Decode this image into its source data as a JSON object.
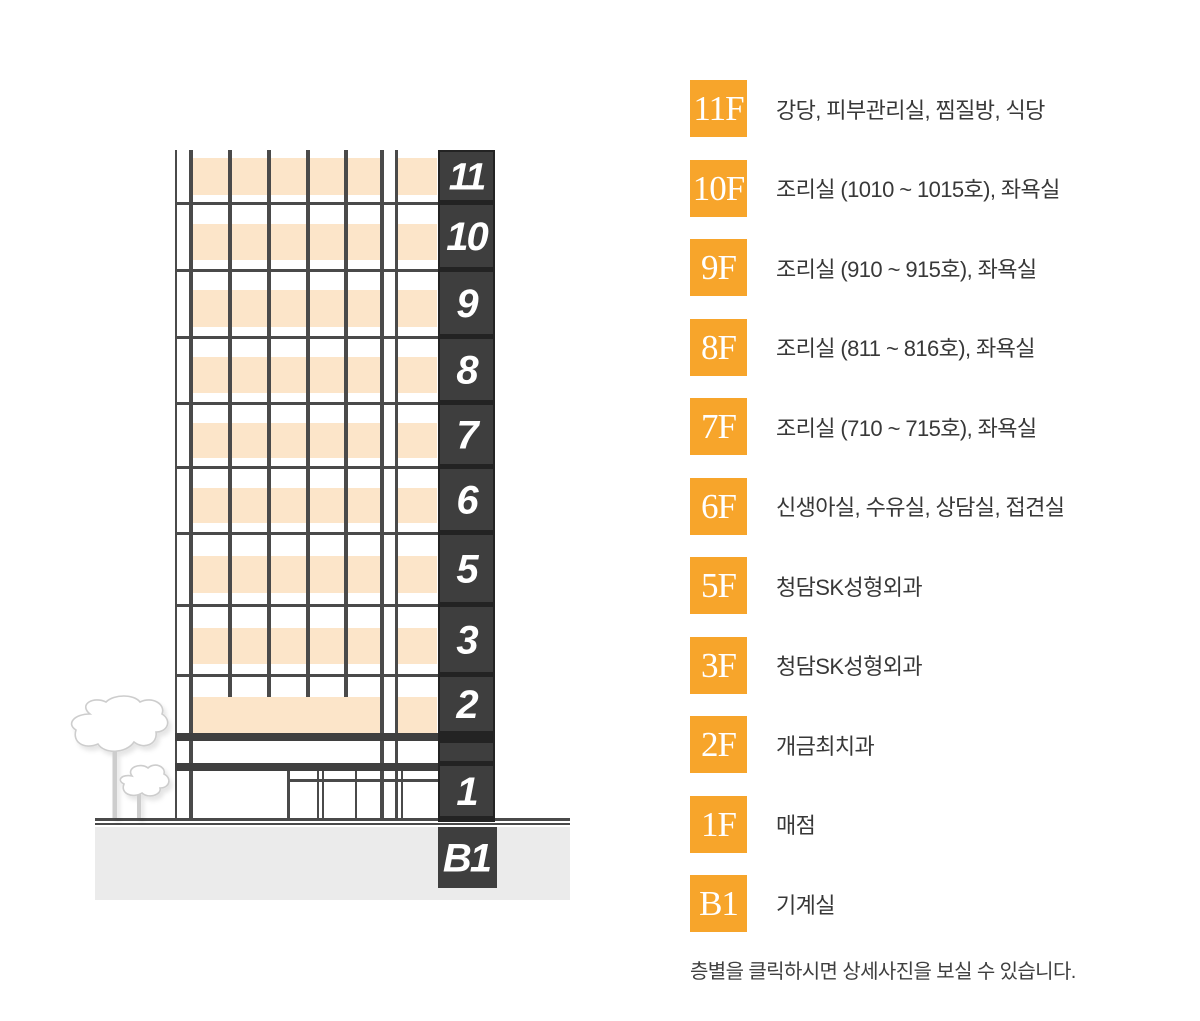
{
  "floors": [
    {
      "building_label": "11",
      "badge": "11F",
      "desc": "강당, 피부관리실, 찜질방, 식당"
    },
    {
      "building_label": "10",
      "badge": "10F",
      "desc": "조리실 (1010 ~ 1015호), 좌욕실"
    },
    {
      "building_label": "9",
      "badge": "9F",
      "desc": "조리실 (910 ~ 915호), 좌욕실"
    },
    {
      "building_label": "8",
      "badge": "8F",
      "desc": "조리실 (811 ~ 816호), 좌욕실"
    },
    {
      "building_label": "7",
      "badge": "7F",
      "desc": "조리실 (710 ~ 715호), 좌욕실"
    },
    {
      "building_label": "6",
      "badge": "6F",
      "desc": "신생아실, 수유실, 상담실, 접견실"
    },
    {
      "building_label": "5",
      "badge": "5F",
      "desc": "청담SK성형외과"
    },
    {
      "building_label": "3",
      "badge": "3F",
      "desc": "청담SK성형외과"
    },
    {
      "building_label": "2",
      "badge": "2F",
      "desc": "개금최치과"
    },
    {
      "building_label": "1",
      "badge": "1F",
      "desc": "매점"
    },
    {
      "building_label": "B1",
      "badge": "B1",
      "desc": "기계실"
    }
  ],
  "note": "층별을 클릭하시면 상세사진을 보실 수 있습니다.",
  "colors": {
    "accent_orange": "#F7A52B",
    "window_peach": "#FCE5C9",
    "line_gray": "#4A4A4A",
    "band_dark": "#3F3F3F",
    "panel_block": "#3E3E3E",
    "panel_border": "#232323",
    "ground_gray": "#EBEBEB",
    "tree_gray": "#CDCDCD",
    "text_dark": "#383838"
  }
}
